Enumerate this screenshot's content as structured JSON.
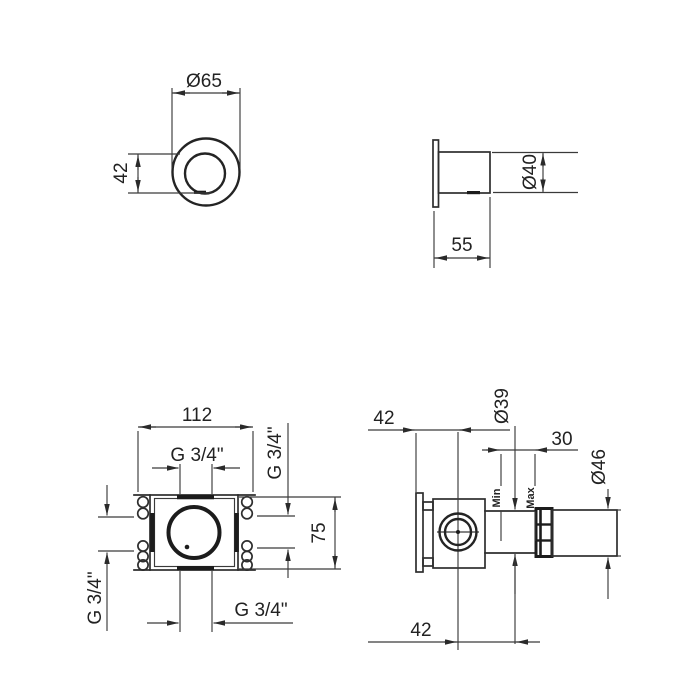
{
  "drawing": {
    "line_color": "#2e2e2e",
    "views": {
      "handle_front": {
        "dims": {
          "diameter": "Ø65",
          "height": "42"
        }
      },
      "handle_side": {
        "dims": {
          "diameter": "Ø40",
          "depth": "55"
        }
      },
      "body_front": {
        "dims": {
          "width": "112",
          "height": "75",
          "thread_top": "G 3/4\"",
          "thread_right": "G 3/4\"",
          "thread_left": "G 3/4\"",
          "thread_bottom": "G 3/4\""
        }
      },
      "body_side": {
        "dims": {
          "wall_to_center": "42",
          "sleeve_diameter": "Ø39",
          "adjust_range": "30",
          "trim_diameter": "Ø46",
          "center_to_wall": "42"
        },
        "labels": {
          "min": "Min",
          "max": "Max"
        }
      }
    }
  }
}
